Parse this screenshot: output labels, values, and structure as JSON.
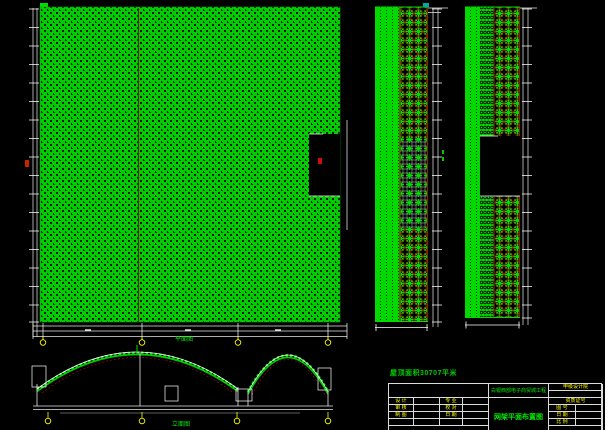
{
  "drawing": {
    "sheet_bg": "#000000",
    "mesh_green": "#00cc00",
    "node_red": "#993300",
    "axis_yellow": "#ffff00",
    "dim_white": "#e8e8e8"
  },
  "annotations": {
    "area_note": "屋顶面积30707平米",
    "plan_view_label": "平面图",
    "elevation_view_label": "立面图"
  },
  "title_block": {
    "project_name": "白银西部电子商贸城工程",
    "drawing_title": "网架平面布置图",
    "org_name": "甲级设计院",
    "cert_label": "资质证号",
    "fig_no_label": "图 号",
    "date_label": "日 期",
    "scale_label": "比 例",
    "rows": [
      {
        "c1": "设 计",
        "c3": "专 业"
      },
      {
        "c1": "审 核",
        "c3": "校 对"
      },
      {
        "c1": "制 图",
        "c3": "日 期"
      }
    ]
  }
}
